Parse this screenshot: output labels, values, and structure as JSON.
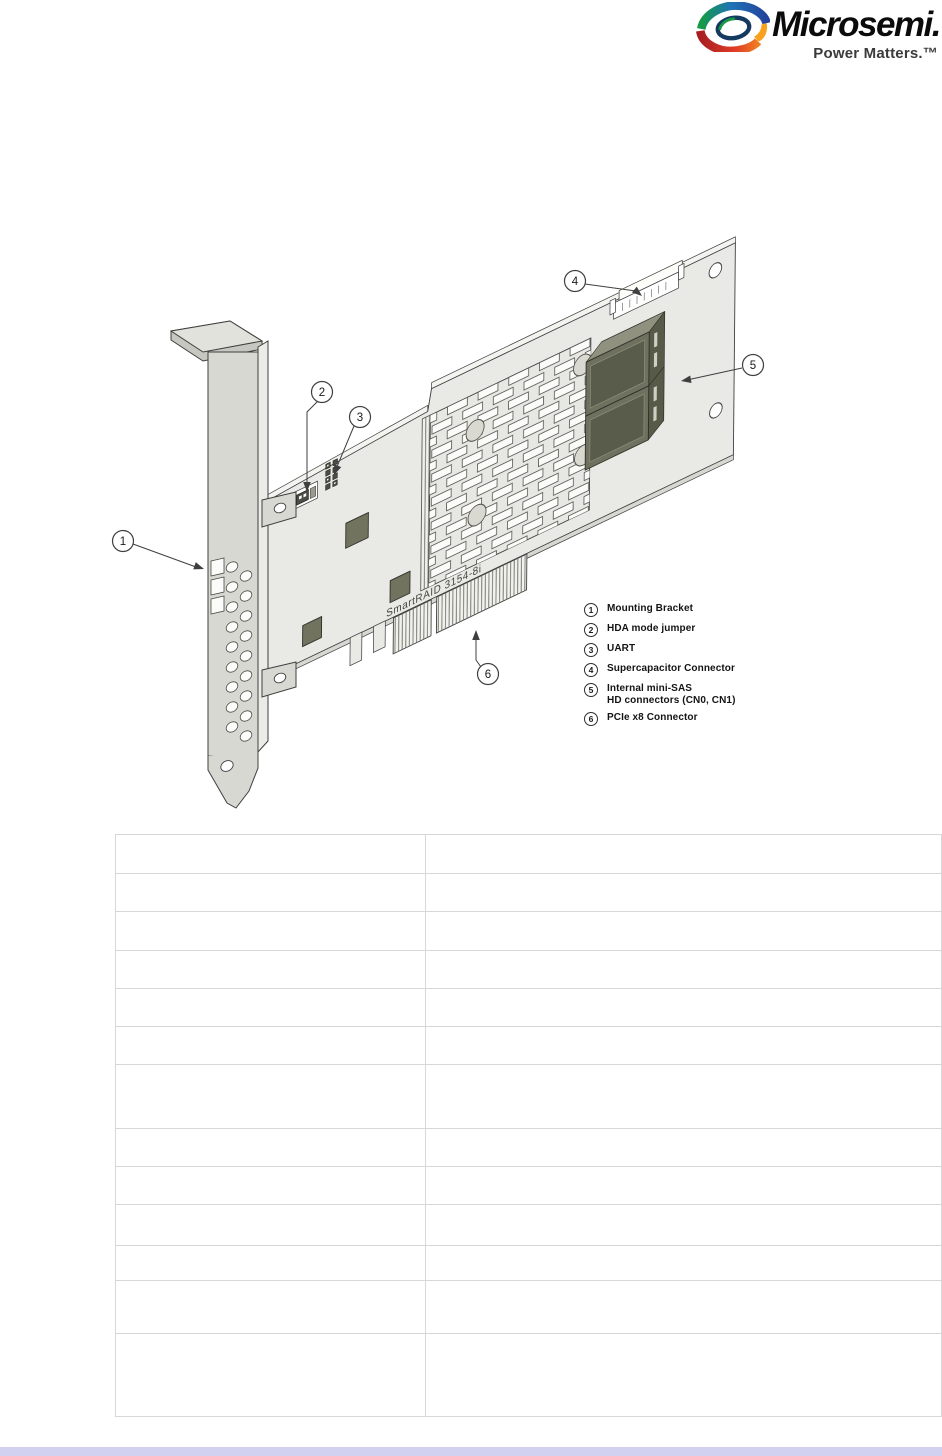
{
  "page": {
    "footer_bar_color": "#d2d2f0"
  },
  "header": {
    "logo": {
      "brand": "Microsemi.",
      "tagline": "Power Matters.™",
      "mark_colors": {
        "green": "#169a47",
        "blue": "#24439c",
        "red": "#a81e22",
        "orange": "#f07c22",
        "yellow": "#f9a11b",
        "navy": "#153a60"
      }
    }
  },
  "figure": {
    "board_label": "SmartRAID 3154-8i",
    "callouts": [
      "1",
      "2",
      "3",
      "4",
      "5",
      "6"
    ],
    "legend": [
      {
        "num": "1",
        "label": "Mounting Bracket"
      },
      {
        "num": "2",
        "label": "HDA mode jumper"
      },
      {
        "num": "3",
        "label": "UART"
      },
      {
        "num": "4",
        "label": "Supercapacitor Connector"
      },
      {
        "num": "5",
        "label": "Internal mini-SAS",
        "label2": "HD connectors (CN0, CN1)"
      },
      {
        "num": "6",
        "label": "PCIe x8 Connector"
      }
    ],
    "colors": {
      "pcb": "#e9e9e6",
      "bracket": "#d8d8d2",
      "connector": "#6f715f",
      "outline": "#3f3f3f"
    }
  },
  "table": {
    "column_count": 2,
    "row_count": 13,
    "rows": [
      [
        "",
        ""
      ],
      [
        "",
        ""
      ],
      [
        "",
        ""
      ],
      [
        "",
        ""
      ],
      [
        "",
        ""
      ],
      [
        "",
        ""
      ],
      [
        "",
        ""
      ],
      [
        "",
        ""
      ],
      [
        "",
        ""
      ],
      [
        "",
        ""
      ],
      [
        "",
        ""
      ],
      [
        "",
        ""
      ],
      [
        "",
        ""
      ]
    ]
  }
}
